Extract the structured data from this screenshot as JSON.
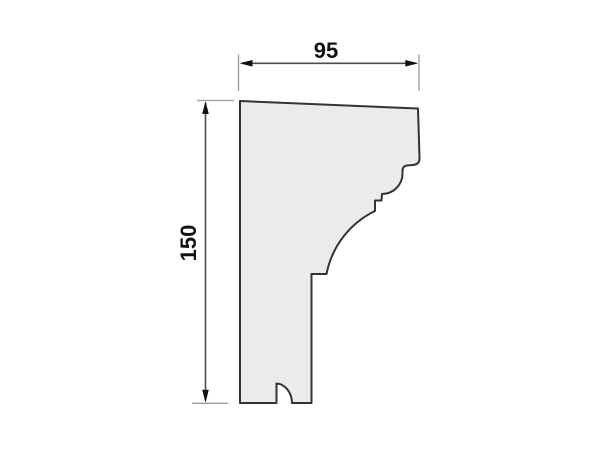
{
  "drawing": {
    "kind": "molding-profile-cross-section",
    "dimensions": {
      "width_label": "95",
      "height_label": "150"
    },
    "icons": {
      "arrows": [
        "arrow-left-icon",
        "arrow-right-icon",
        "arrow-up-icon",
        "arrow-down-icon"
      ]
    },
    "colors": {
      "background": "#ffffff",
      "profile_fill": "#ebebeb",
      "profile_outline": "#333333",
      "dimension_line": "#4d4d4d",
      "extension_line": "#9b9b9b",
      "arrow": "#111111",
      "label_text": "#111111"
    }
  }
}
